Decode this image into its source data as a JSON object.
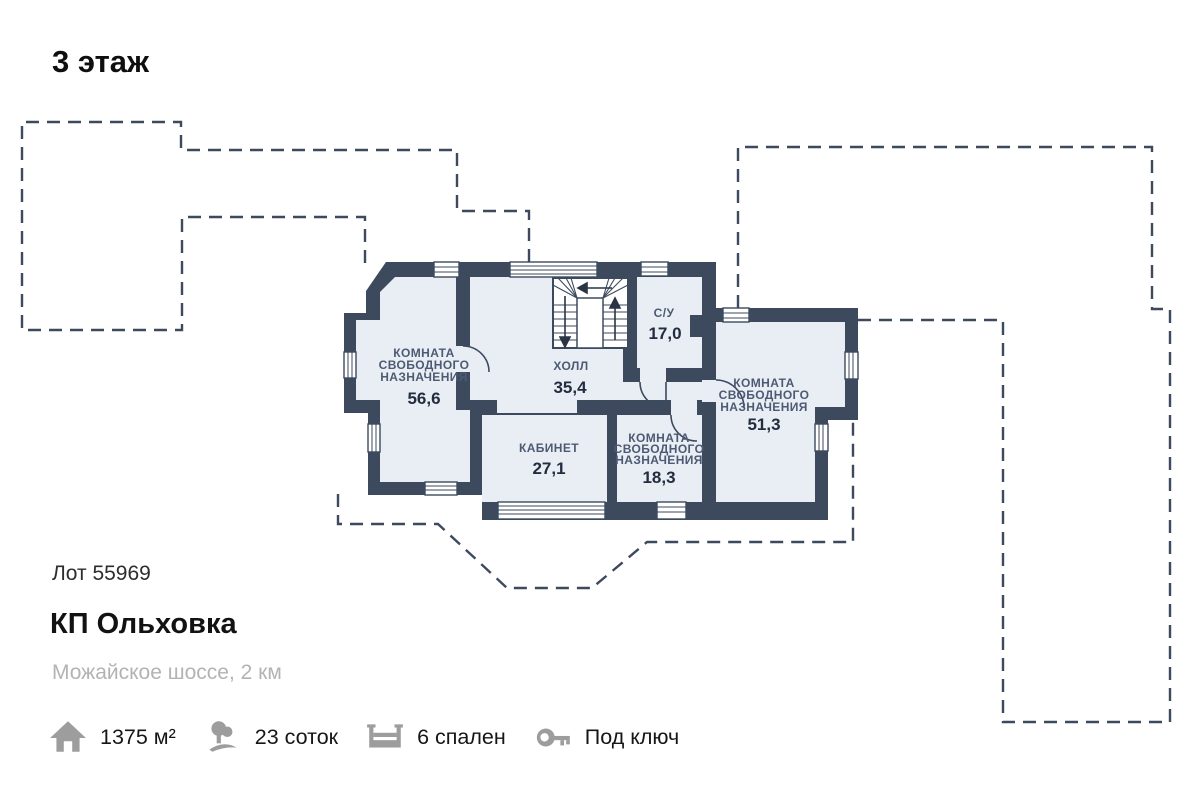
{
  "title": "3 этаж",
  "plan": {
    "rooms": {
      "room_left": {
        "line1": "КОМНАТА",
        "line2": "СВОБОДНОГО",
        "line3": "НАЗНАЧЕНИЯ",
        "area": "56,6"
      },
      "hall": {
        "line1": "ХОЛЛ",
        "area": "35,4"
      },
      "bathroom": {
        "line1": "С/У",
        "area": "17,0"
      },
      "room_right": {
        "line1": "КОМНАТА",
        "line2": "СВОБОДНОГО",
        "line3": "НАЗНАЧЕНИЯ",
        "area": "51,3"
      },
      "cabinet": {
        "line1": "КАБИНЕТ",
        "area": "27,1"
      },
      "room_bottom": {
        "line1": "КОМНАТА",
        "line2": "СВОБОДНОГО",
        "line3": "НАЗНАЧЕНИЯ",
        "area": "18,3"
      }
    },
    "colors": {
      "wall": "#3d4a5e",
      "floor": "#e9eef4",
      "label": "#4d5a73",
      "area": "#232d3f",
      "icon_gray": "#9d9d9d"
    }
  },
  "listing": {
    "lot": "Лот 55969",
    "name": "КП Ольховка",
    "location": "Можайское шоссе, 2 км"
  },
  "stats": {
    "area": {
      "label": "1375 м²",
      "icon": "house-icon"
    },
    "land": {
      "label": "23 соток",
      "icon": "trees-icon"
    },
    "bedrooms": {
      "label": "6 спален",
      "icon": "bed-icon"
    },
    "finish": {
      "label": "Под ключ",
      "icon": "key-icon"
    }
  }
}
